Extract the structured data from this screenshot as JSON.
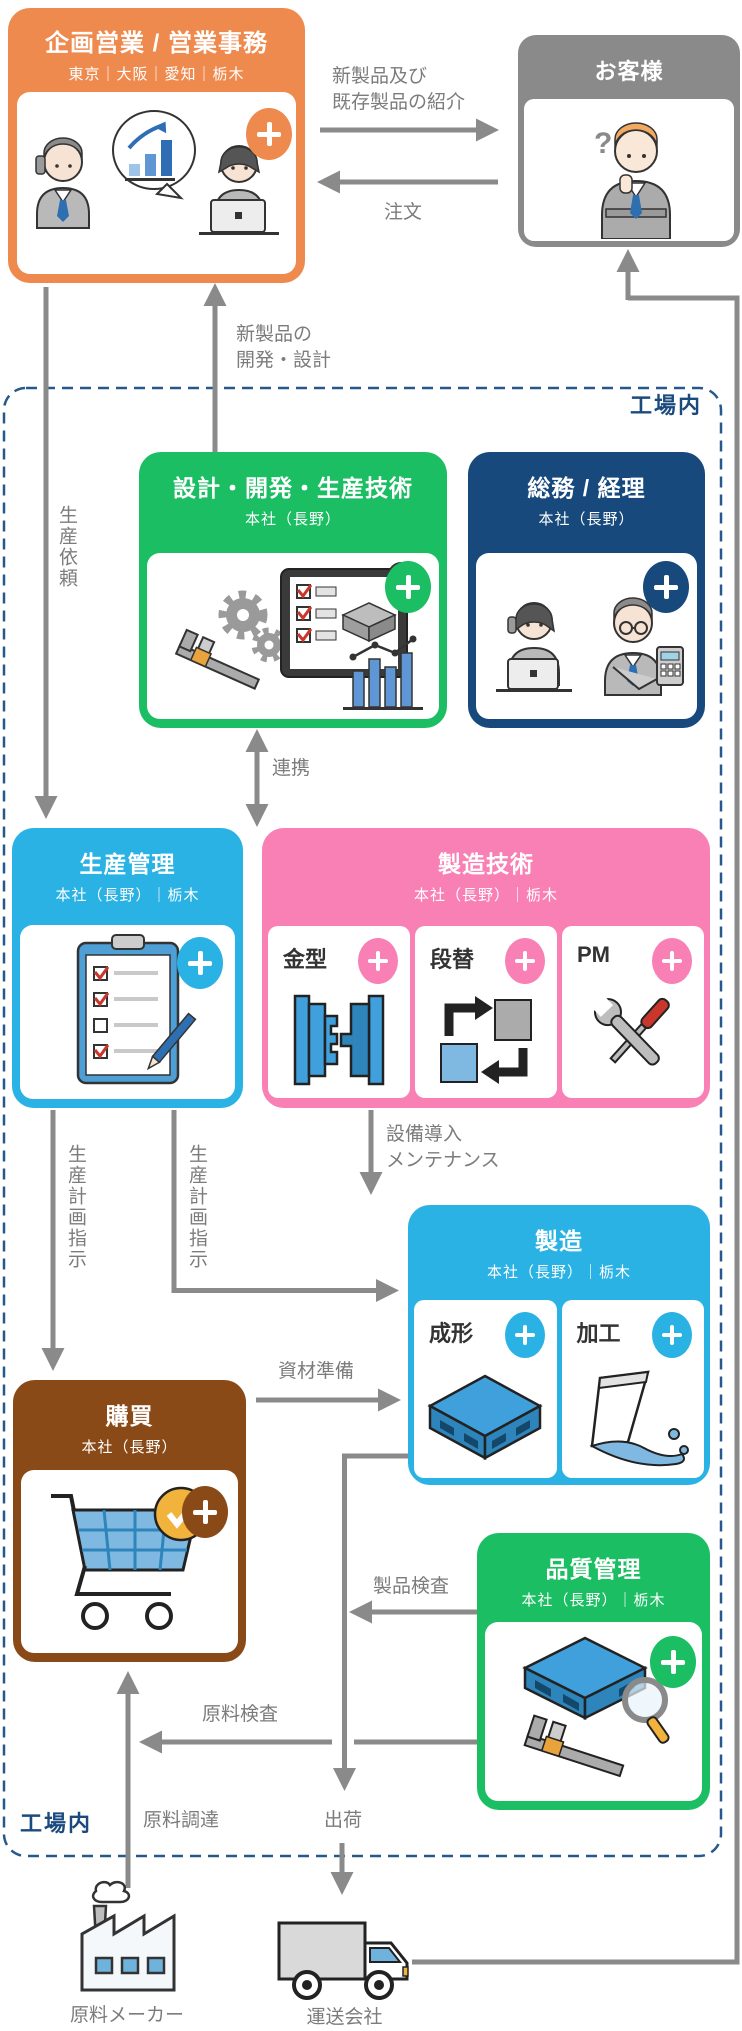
{
  "zone": {
    "factory_label": "工場内"
  },
  "nodes": {
    "planning_sales": {
      "title": "企画営業 / 営業事務",
      "locations": "東京｜大阪｜愛知｜栃木"
    },
    "customer": {
      "title": "お客様",
      "question_mark": "?"
    },
    "design_dev": {
      "title": "設計・開発・生産技術",
      "locations": "本社（長野）"
    },
    "general_affairs": {
      "title": "総務 / 経理",
      "locations": "本社（長野）"
    },
    "production_mgmt": {
      "title": "生産管理",
      "locations": "本社（長野）｜栃木"
    },
    "mfg_tech": {
      "title": "製造技術",
      "locations": "本社（長野）｜栃木",
      "subunits": [
        "金型",
        "段替",
        "PM"
      ]
    },
    "manufacturing": {
      "title": "製造",
      "locations": "本社（長野）｜栃木",
      "subunits": [
        "成形",
        "加工"
      ]
    },
    "purchasing": {
      "title": "購買",
      "locations": "本社（長野）"
    },
    "quality": {
      "title": "品質管理",
      "locations": "本社（長野）｜栃木"
    },
    "raw_material_maker": {
      "label": "原料メーカー"
    },
    "shipping_company": {
      "label": "運送会社"
    }
  },
  "flows": {
    "intro": {
      "line1": "新製品及び",
      "line2": "既存製品の紹介"
    },
    "order": "注文",
    "new_product_dev": {
      "line1": "新製品の",
      "line2": "開発・設計"
    },
    "production_request": "生産依頼",
    "cooperation": "連携",
    "production_plan_1": "生産計画指示",
    "production_plan_2": "生産計画指示",
    "equipment": {
      "line1": "設備導入",
      "line2": "メンテナンス"
    },
    "material_prep": "資材準備",
    "shipping": "出荷",
    "product_inspection": "製品検査",
    "raw_material_inspection": "原料検査",
    "raw_material_procurement": "原料調達"
  },
  "colors": {
    "orange": "#EF8A4E",
    "customer_gray": "#8A8A8A",
    "green": "#1CBE63",
    "navy": "#17497C",
    "cyan": "#29B2E3",
    "pink": "#F980B4",
    "brown": "#8A4A18",
    "dashed_border": "#27588C",
    "arrow_gray": "#8A8A8A",
    "label_gray": "#7C7C7C"
  }
}
